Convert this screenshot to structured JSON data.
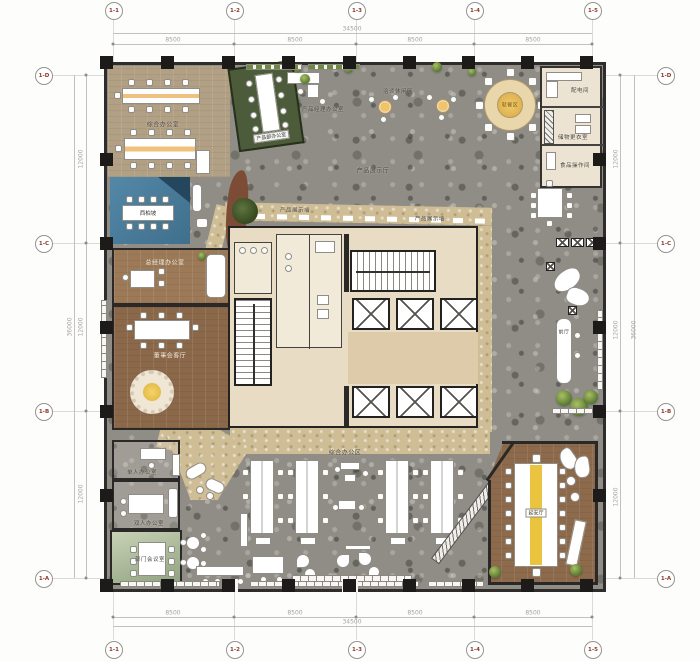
{
  "axes": {
    "top": [
      "1-1",
      "1-2",
      "1-3",
      "1-4",
      "1-5"
    ],
    "bottom": [
      "1-1",
      "1-2",
      "1-3",
      "1-4",
      "1-5"
    ],
    "left": [
      "1-D",
      "1-C",
      "1-B",
      "1-A"
    ],
    "right": [
      "1-D",
      "1-C",
      "1-B",
      "1-A"
    ]
  },
  "dims": {
    "top_total": "34500",
    "bottom_total": "34500",
    "top_segments": [
      "8500",
      "8500",
      "8500",
      "8500"
    ],
    "bottom_segments": [
      "8500",
      "8500",
      "8500",
      "8500"
    ],
    "left_segments": [
      "12000",
      "12000",
      "12000"
    ],
    "right_segments": [
      "12000",
      "12000",
      "12000"
    ],
    "left_total": "36000",
    "right_total": "36000"
  },
  "rooms": {
    "general_office": "综合办公室",
    "xibaipo": "西柏坡",
    "gm_office": "总经理办公室",
    "board_lounge": "董事会客厅",
    "product_dept_office": "产品部办公室",
    "product_manager_office": "产品经理办公室",
    "leisure_area": "洽谈休闲区",
    "dining_area": "就餐区",
    "power_room": "配电间",
    "locker_room": "储物更衣室",
    "food_room": "食品操作间",
    "exhibition_area": "产品展示厅",
    "display_wall": "产品展示墙",
    "front_hall": "前厅",
    "single_office": "单人办公室",
    "double_office": "双人办公室",
    "dept_meeting_room": "部门会议室",
    "open_office": "综合办公区",
    "yanan_hall": "延安厅"
  }
}
